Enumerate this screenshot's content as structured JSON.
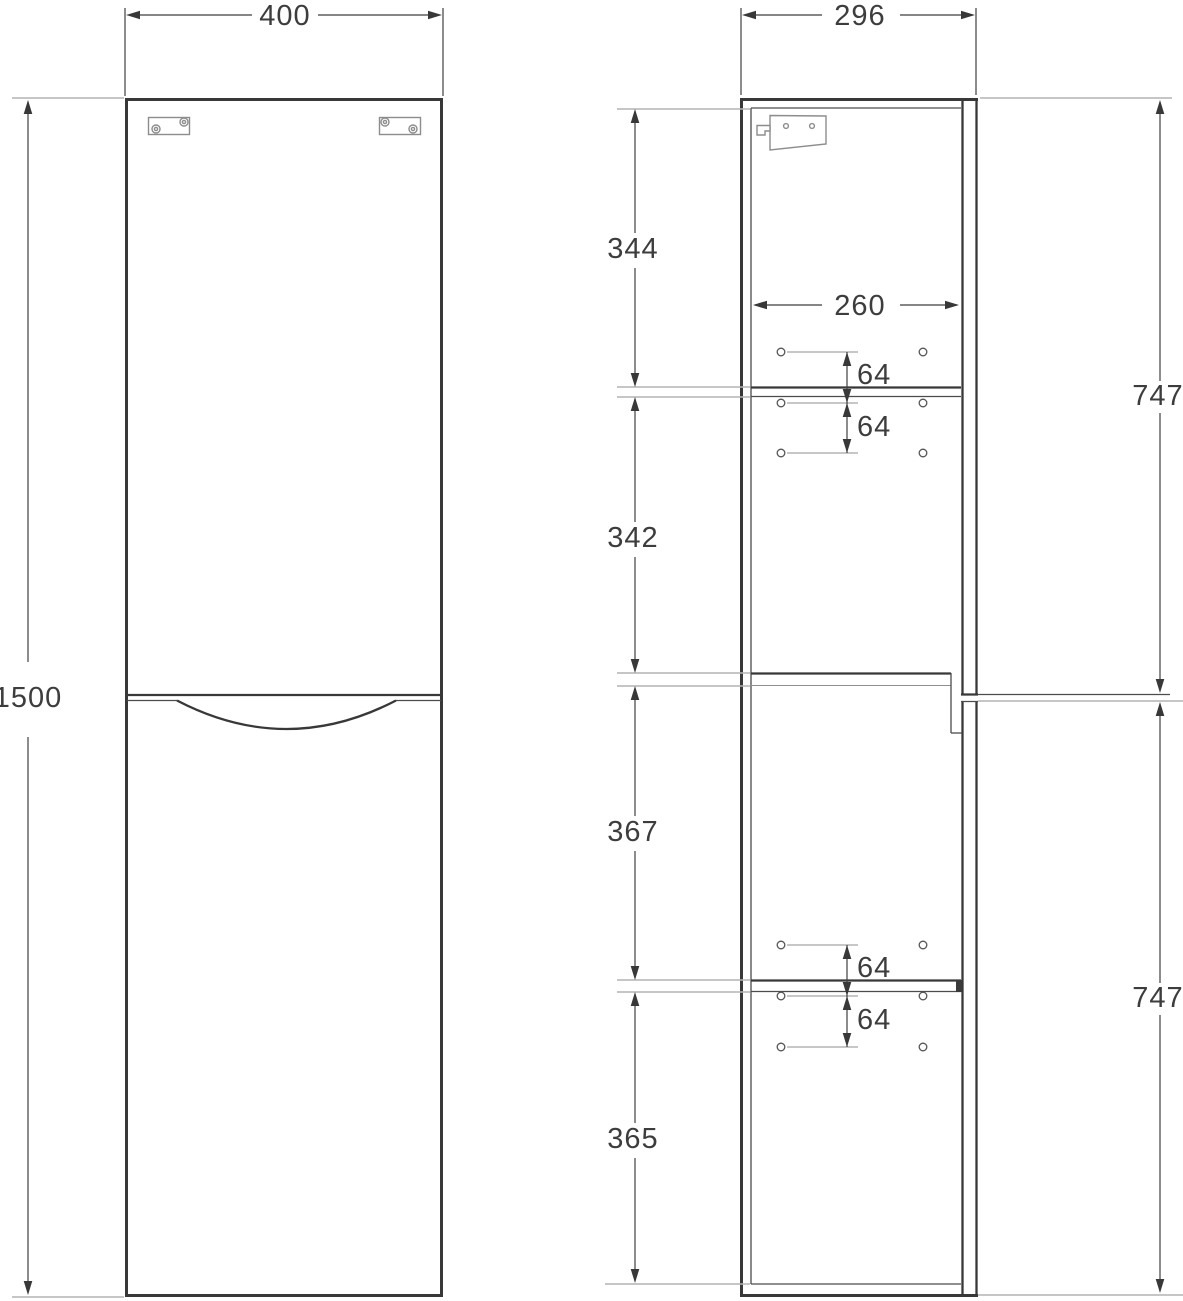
{
  "drawing": {
    "front_view": {
      "width": "400",
      "height": "1500"
    },
    "side_view": {
      "depth": "296",
      "interior_depth": "260",
      "upper_door_height": "747",
      "lower_door_height": "747",
      "top_section": "344",
      "upper_mid_section": "342",
      "lower_mid_section": "367",
      "bottom_section": "365",
      "hole_spacing_upper_a": "64",
      "hole_spacing_upper_b": "64",
      "hole_spacing_lower_a": "64",
      "hole_spacing_lower_b": "64"
    }
  }
}
